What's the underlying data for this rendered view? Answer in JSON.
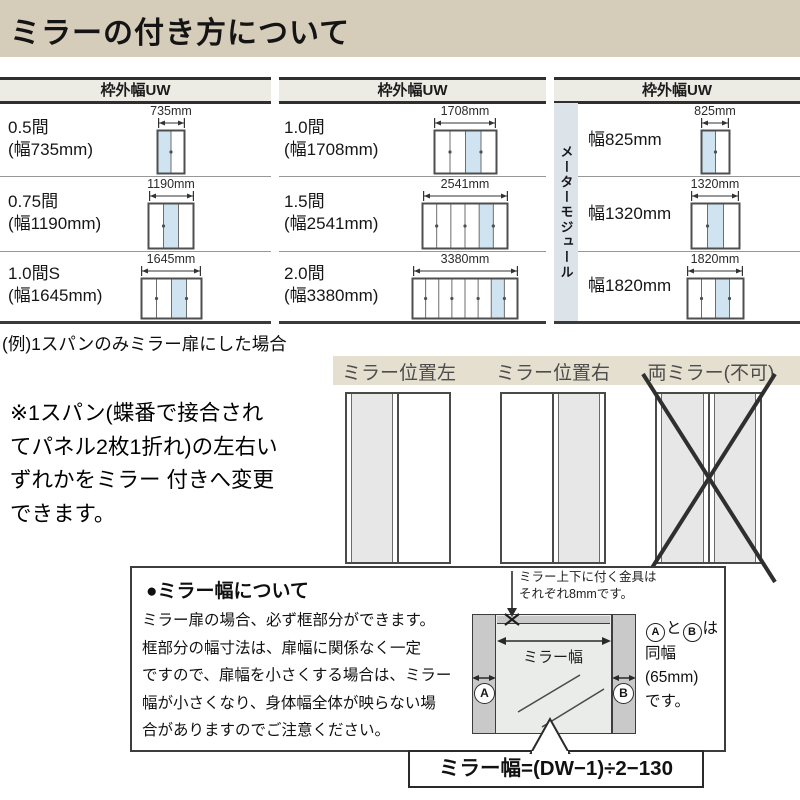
{
  "page": {
    "title": "ミラーの付き方について"
  },
  "colors": {
    "title_bg": "#d6ccba",
    "table_header_bg": "#edece4",
    "mirror_panel_blue": "#cfe4f0",
    "meter_module_strip_bg": "#dce4ea",
    "position_label_strip_bg": "#e5dfd0",
    "example_mirror_gray": "#e7e7e7",
    "stile_gray": "#c9c9c9",
    "mirror_face": "#eaece9"
  },
  "table": {
    "header_label": "枠外幅UW",
    "columns": [
      {
        "x": 0,
        "w": 271,
        "label_x": 8,
        "door_cx": 171,
        "rows": [
          {
            "name": "0.5間",
            "sub": "(幅735mm)",
            "dim": "735mm",
            "door": {
              "w": 27,
              "panels": 2,
              "mirror": 0
            }
          },
          {
            "name": "0.75間",
            "sub": "(幅1190mm)",
            "dim": "1190mm",
            "door": {
              "w": 45,
              "panels": 3,
              "mirror": 1
            }
          },
          {
            "name": "1.0間S",
            "sub": "(幅1645mm)",
            "dim": "1645mm",
            "door": {
              "w": 60,
              "panels": 4,
              "mirror": 2
            }
          }
        ]
      },
      {
        "x": 279,
        "w": 267,
        "label_x": 284,
        "door_cx": 465,
        "rows": [
          {
            "name": "1.0間",
            "sub": "(幅1708mm)",
            "dim": "1708mm",
            "door": {
              "w": 62,
              "panels": 4,
              "mirror": 2
            }
          },
          {
            "name": "1.5間",
            "sub": "(幅2541mm)",
            "dim": "2541mm",
            "door": {
              "w": 85,
              "panels": 6,
              "mirror": 4
            }
          },
          {
            "name": "2.0間",
            "sub": "(幅3380mm)",
            "dim": "3380mm",
            "door": {
              "w": 105,
              "panels": 8,
              "mirror": 6
            }
          }
        ]
      },
      {
        "x": 554,
        "w": 246,
        "label_x": 588,
        "door_cx": 715,
        "strip_label": "メーターモジュール",
        "rows": [
          {
            "name": "幅825mm",
            "sub": "",
            "dim": "825mm",
            "door": {
              "w": 28,
              "panels": 2,
              "mirror": 0
            }
          },
          {
            "name": "幅1320mm",
            "sub": "",
            "dim": "1320mm",
            "door": {
              "w": 48,
              "panels": 3,
              "mirror": 1
            }
          },
          {
            "name": "幅1820mm",
            "sub": "",
            "dim": "1820mm",
            "door": {
              "w": 56,
              "panels": 4,
              "mirror": 2
            }
          }
        ]
      }
    ],
    "row_tops": [
      103,
      176,
      251
    ],
    "row_bottoms": [
      176,
      251,
      321
    ]
  },
  "example": {
    "caption": "(例)1スパンのみミラー扉にした場合",
    "note_lines": [
      "※1スパン(蝶番で接合され",
      "てパネル2枚1折れ)の左右い",
      "ずれかをミラー 付きへ変更",
      "できます。"
    ],
    "labels": [
      "ミラー位置左",
      "ミラー位置右",
      "両ミラー(不可)"
    ],
    "diagrams": [
      {
        "type": "left"
      },
      {
        "type": "right"
      },
      {
        "type": "both_crossed"
      }
    ]
  },
  "mirror_info": {
    "title": "●ミラー幅について",
    "body_lines": [
      "ミラー扉の場合、必ず框部分ができます。",
      "框部分の幅寸法は、扉幅に関係なく一定",
      "ですので、扉幅を小さくする場合は、ミラー",
      "幅が小さくなり、身体幅全体が映らない場",
      "合がありますのでご注意ください。"
    ],
    "hardware_note_lines": [
      "ミラー上下に付く金具は",
      "それぞれ8mmです。"
    ],
    "mirror_width_label": "ミラー幅",
    "side_a": "A",
    "side_b": "B",
    "side_note": {
      "and": "と",
      "suffix": "は",
      "lines": [
        "同幅",
        "(65mm)",
        "です。"
      ]
    },
    "formula": "ミラー幅=(DW−1)÷2−130"
  }
}
